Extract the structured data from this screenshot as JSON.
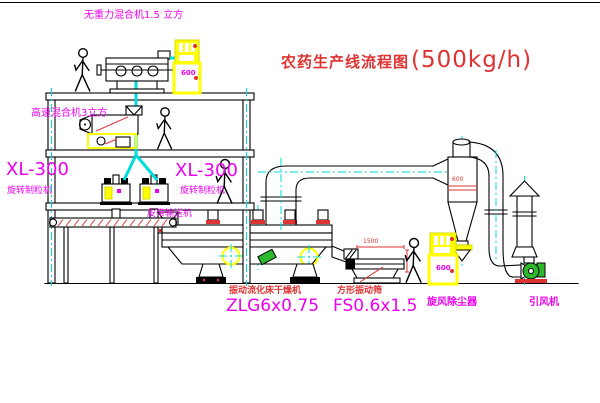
{
  "title": {
    "name_cn": "农药生产线流程图",
    "capacity": "(500kg/h)"
  },
  "equipment_labels": {
    "gravity_mixer": "无重力混合机1.5 立方",
    "high_speed_mixer": "高速混合机3立方",
    "granulator_left_model": "XL-300",
    "granulator_left_name": "旋转制粒机",
    "granulator_right_model": "XL-300",
    "granulator_right_name": "旋转制粒机",
    "belt_conveyor": "皮带输送机",
    "dryer_name": "振动流化床干燥机",
    "dryer_model": "ZLG6x0.75",
    "screen_name": "方形振动筛",
    "screen_model": "FS0.6x1.5",
    "cyclone_name": "旋风除尘器",
    "fan_name": "引风机"
  },
  "dimensions": {
    "cyclone_diameter": "600",
    "screen_length": "1500"
  },
  "control_panels": {
    "panel_top_text": "600",
    "panel_right_text": "600"
  },
  "colors": {
    "line": "#000000",
    "centerline": "#00dcdc",
    "annotation_magenta": "#ee00ee",
    "annotation_red": "#dd3333",
    "equipment_yellow": "#ffff00",
    "machine_green": "#2eb82e",
    "background": "#ffffff"
  }
}
